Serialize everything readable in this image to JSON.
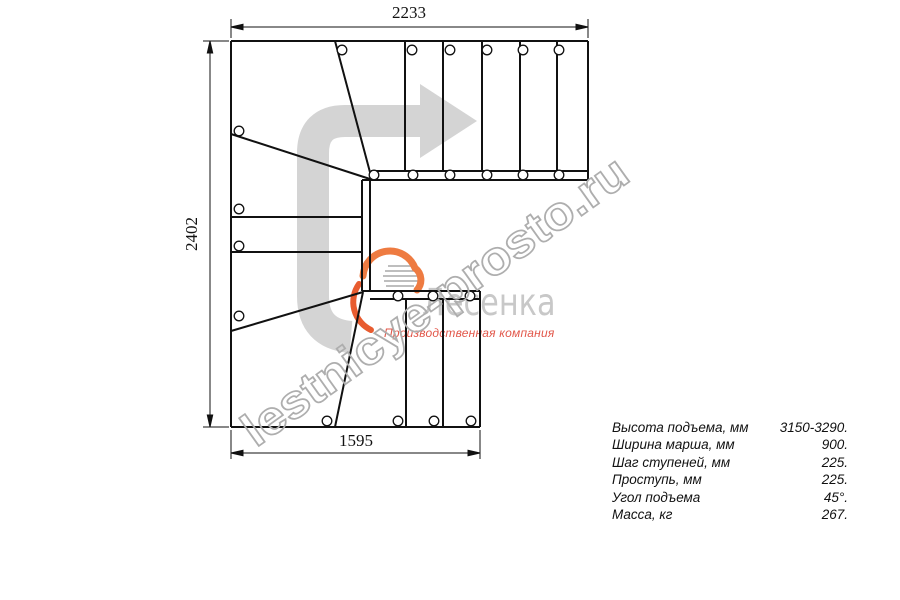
{
  "drawing": {
    "type": "stair-plan-top-view",
    "dimensions": {
      "top_mm": "2233",
      "left_mm": "2402",
      "bottom_mm": "1595"
    }
  },
  "watermark": {
    "site": "lestnicye-prosto.ru"
  },
  "logo": {
    "brand": "Лесенка",
    "tagline": "Производственная компания"
  },
  "specs": {
    "rows": [
      {
        "label": "Высота подъема, мм",
        "value": "3150-3290."
      },
      {
        "label": "Ширина марша, мм",
        "value": "900."
      },
      {
        "label": "Шаг ступеней, мм",
        "value": "225."
      },
      {
        "label": "Проступь, мм",
        "value": "225."
      },
      {
        "label": "Угол подъема",
        "value": "45°."
      },
      {
        "label": "Масса, кг",
        "value": "267."
      }
    ]
  },
  "colors": {
    "line": "#111111",
    "arrow_gray": "#d4d4d4",
    "watermark_gray": "#aeaeae",
    "logo_gray": "#c8c8c8",
    "logo_red": "#e2574a",
    "logo_orange": "#ee7b41",
    "logo_orange_dark": "#e85c30"
  }
}
